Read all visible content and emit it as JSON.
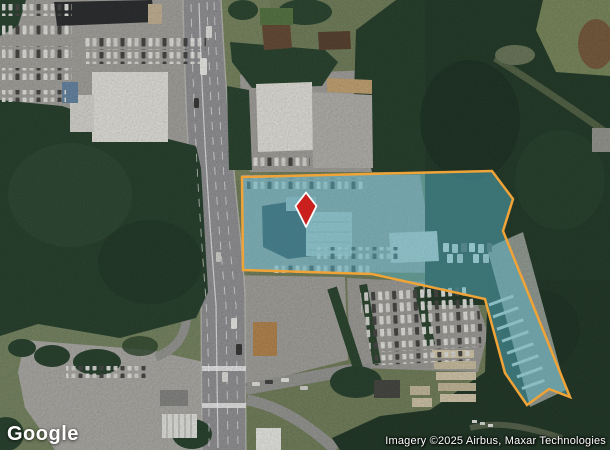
{
  "map": {
    "provider_logo": "Google",
    "attribution": "Imagery ©2025 Airbus, Maxar Technologies",
    "parcel": {
      "points": "242,177 492,171 513,199 503,231 570,397 549,389 527,405 505,373 485,299 372,274 243,270",
      "fill": "rgba(86,177,195,0.5)",
      "stroke": "#F0A438",
      "stroke_width": "2.5"
    },
    "pin": {
      "points": "306,192.5 316.5,206 306,227 295.5,206",
      "fill": "#C9201D",
      "stroke": "#FFFFFF"
    }
  }
}
